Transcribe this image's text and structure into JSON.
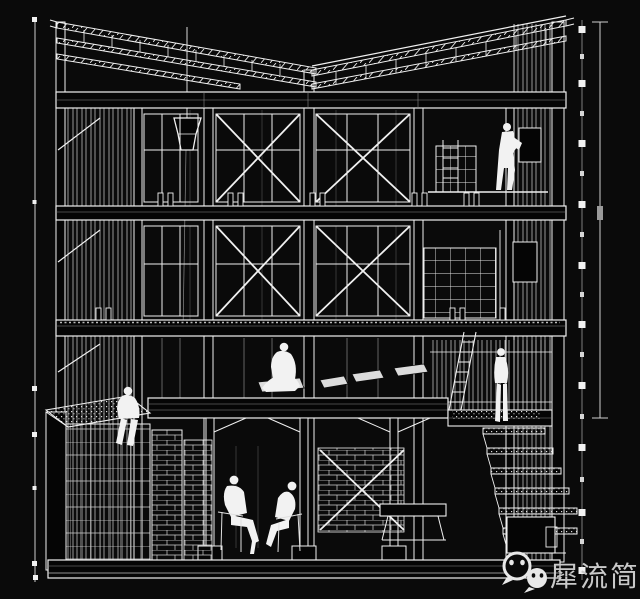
{
  "watermark": {
    "text": "犀流简报",
    "icon": "wechat-icon",
    "text_color": "#c9c9c9"
  },
  "canvas": {
    "background": "#0a0a0a",
    "line_color": "#f0f0f0",
    "secondary_line_color": "#9a9a9a",
    "drawing_type": "black-and-white sectional perspective architectural drawing"
  }
}
